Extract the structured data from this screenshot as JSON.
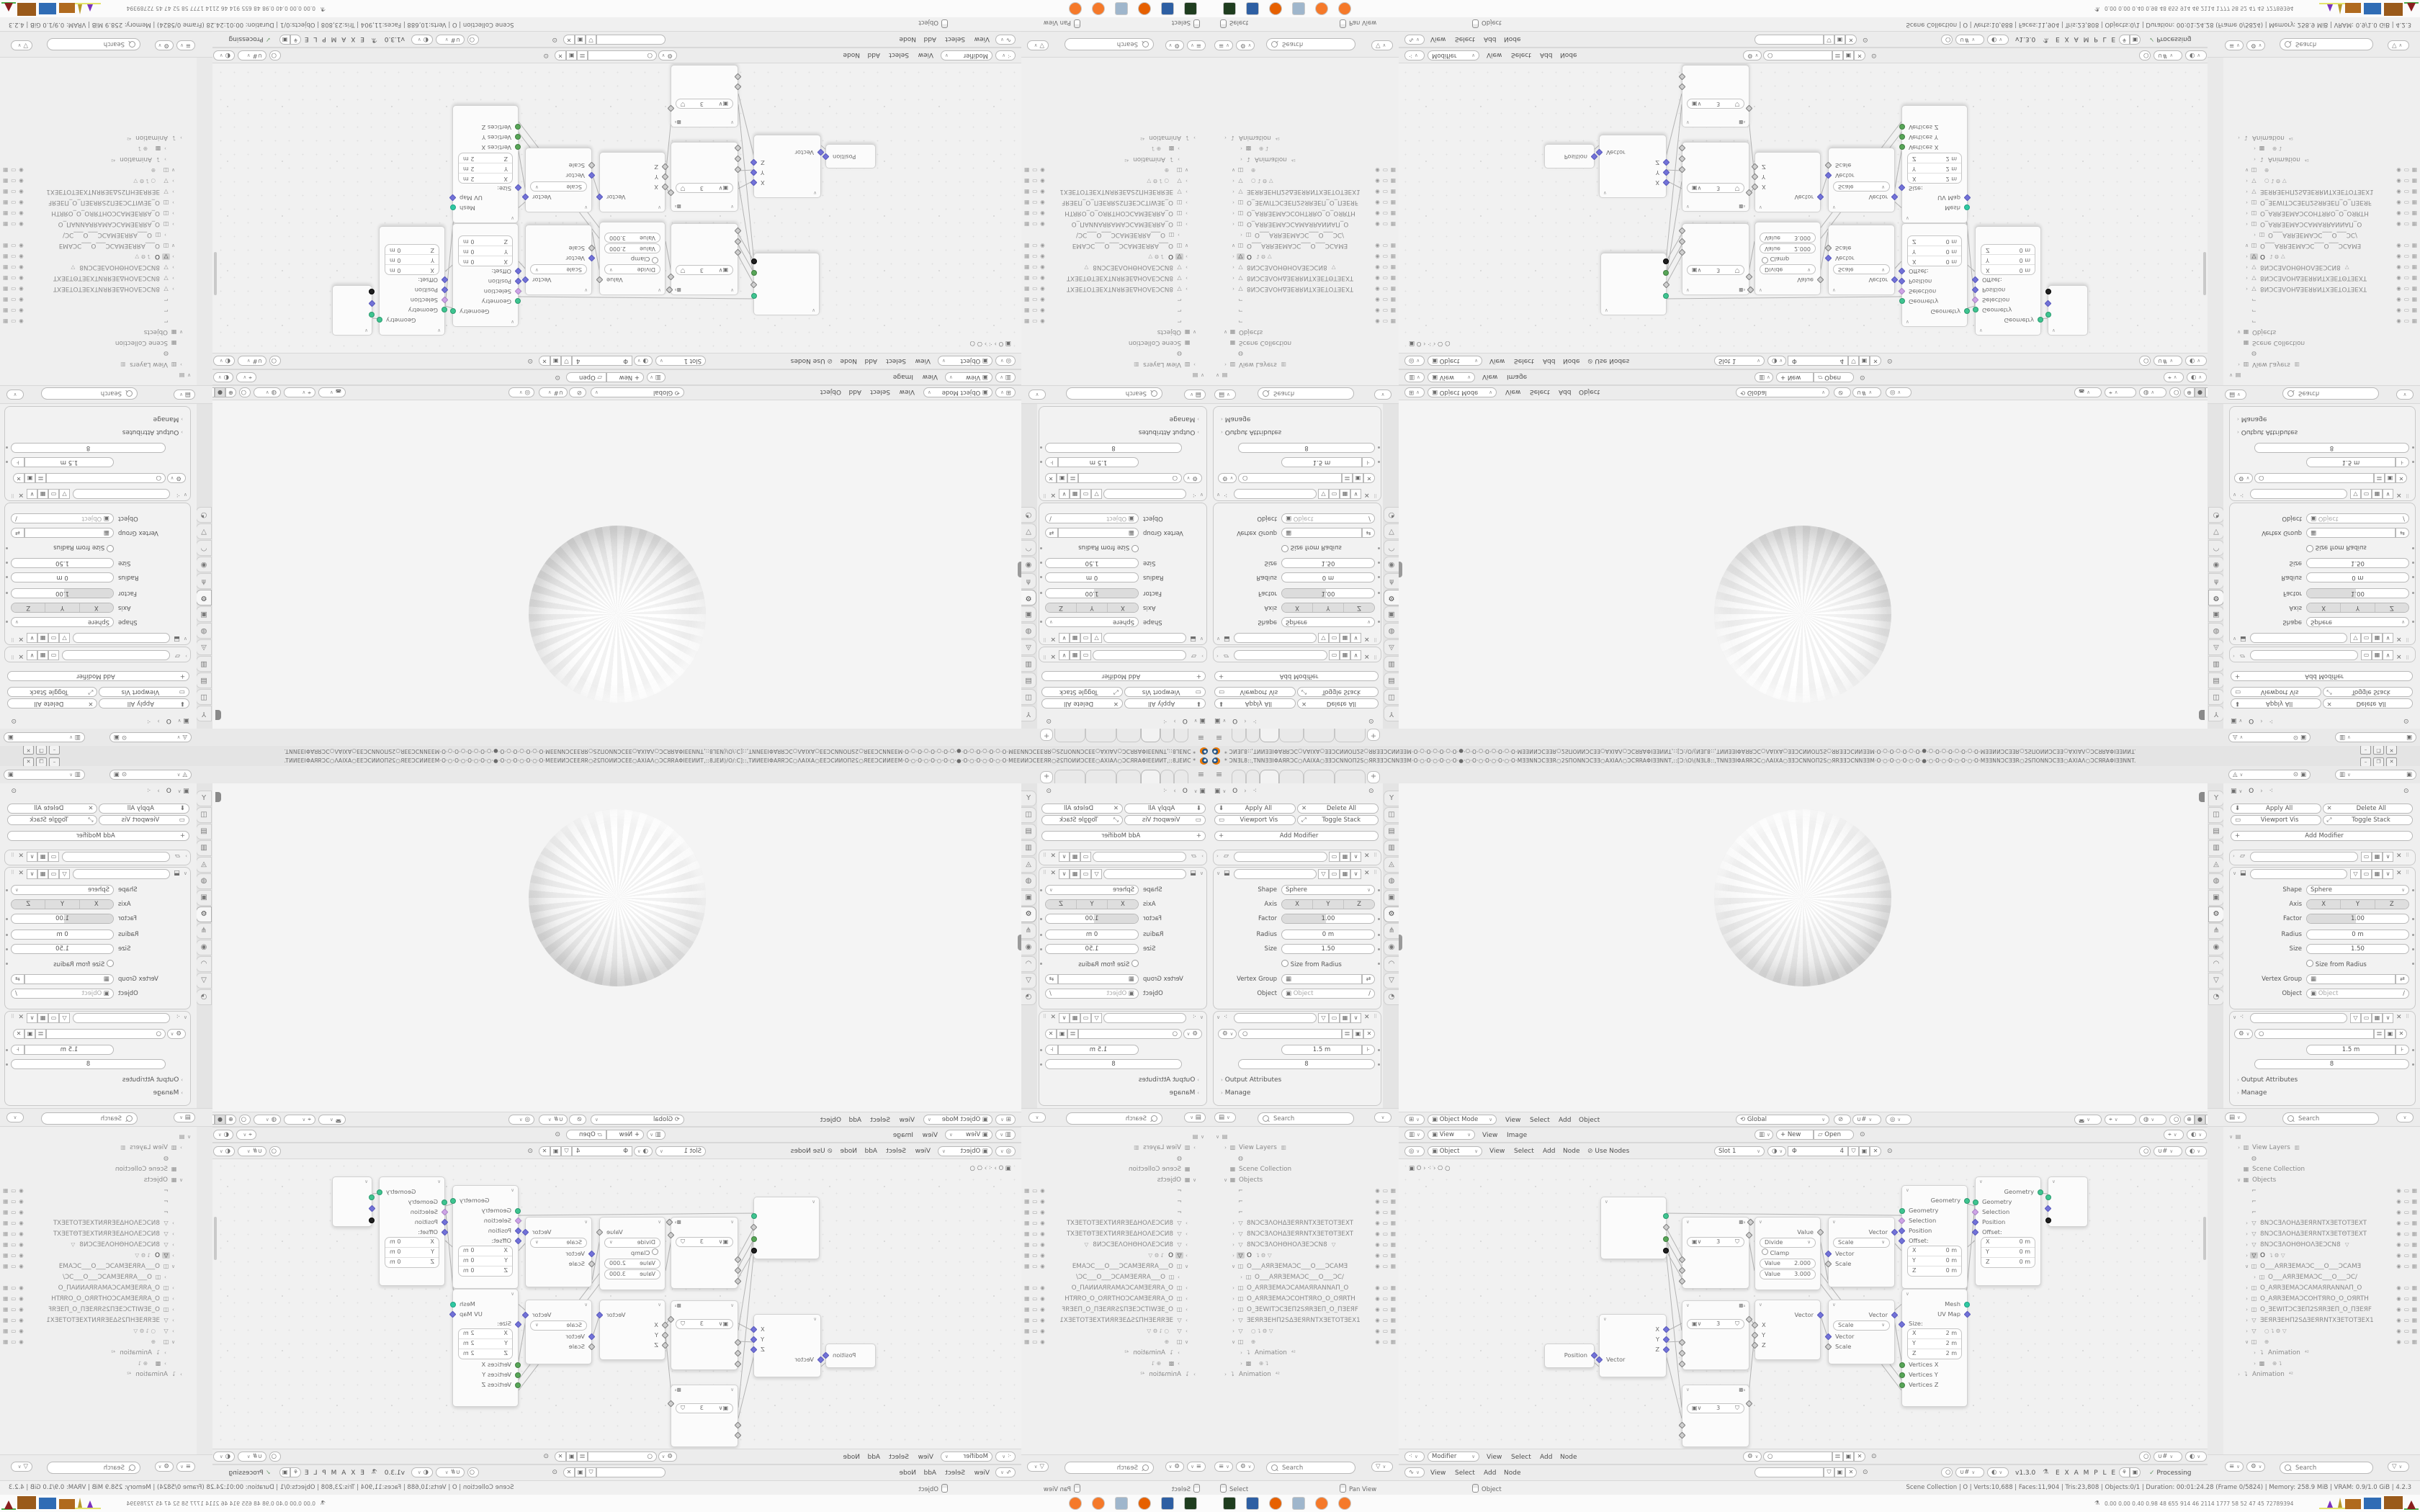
{
  "titlebar": {
    "title": "* ƆNƎL8::,TNNƎƎIΦAЯRƆC○ΛAIXA○ƎƎƆCNNOΠ2S○ЯRƎƎƆCNNƎƎM·O·○·O·○·O·○·O·●·○·O·○·O·○·O·○·O·MƎƎNNƆCƎƎR○2SΠONNƆCƎƎ○AXIAΛ○ƆCЯRAΦIƎƎNNT,::[Ɔ:\\O\\(NƎL8::,TNNƎƎIΦAЯRƆC○ΛAIXA○ƎƎƆCNNOΠ2S○ЯRƎƎƆCNNƎƎM·O·○·O·○·O·○·O·●·○·O·○·O·○·O·○·O·MƎƎNNƆCƎƎR○2SΠONNƆCƎƎ○AXIAΛ○ƆCЯRAΦIƎƎNNT.",
    "minimize": "–",
    "maximize": "❐",
    "close": "✕"
  },
  "topbar": {
    "add_tab": "+"
  },
  "scene_selector": {
    "value": "",
    "viewlayer": ""
  },
  "properties": {
    "breadcrumb_object": "O",
    "toolbar": {
      "apply_all": "Apply All",
      "delete_all": "Delete All",
      "viewport_vis": "Viewport Vis",
      "toggle_stack": "Toggle Stack",
      "add_modifier": "Add Modifier"
    },
    "cast": {
      "shape_label": "Shape",
      "shape_value": "Sphere",
      "axis_label": "Axis",
      "axis_x": "X",
      "axis_y": "Y",
      "axis_z": "Z",
      "factor_label": "Factor",
      "factor_value": "1.00",
      "radius_label": "Radius",
      "radius_value": "0 m",
      "size_label": "Size",
      "size_value": "1.50",
      "size_from_radius": "Size from Radius",
      "vertex_group_label": "Vertex Group",
      "object_label": "Object",
      "object_placeholder": "Object"
    },
    "geonodes": {
      "socket1_value": "1.5 m",
      "socket2_value": "8",
      "output_attributes": "Output Attributes",
      "manage": "Manage"
    },
    "nav_icons": [
      {
        "g": "Y",
        "name": "tool-tab"
      },
      {
        "g": "◫",
        "name": "render-tab"
      },
      {
        "g": "▤",
        "name": "output-tab"
      },
      {
        "g": "▥",
        "name": "view-layer-tab"
      },
      {
        "g": "◬",
        "name": "scene-tab"
      },
      {
        "g": "◍",
        "name": "world-tab"
      },
      {
        "g": "▣",
        "name": "object-tab"
      },
      {
        "g": "⚙",
        "name": "modifiers-tab",
        "active": 1
      },
      {
        "g": "⋔",
        "name": "constraints-tab"
      },
      {
        "g": "◉",
        "name": "particles-tab"
      },
      {
        "g": "◠",
        "name": "physics-tab"
      },
      {
        "g": "▽",
        "name": "data-tab"
      },
      {
        "g": "◔",
        "name": "material-tab"
      }
    ]
  },
  "outliner": {
    "search_placeholder": "Search",
    "rows": [
      {
        "ind": 0,
        "disc": "∨",
        "icon": "▤",
        "label": "",
        "tog": 0
      },
      {
        "ind": 1,
        "disc": "›",
        "icon": "▥",
        "label": "View Layers",
        "extra": "▥",
        "tog": 0
      },
      {
        "ind": 2,
        "disc": "",
        "icon": "◍",
        "label": "",
        "tog": 0
      },
      {
        "ind": 1,
        "disc": "",
        "icon": "▦",
        "label": "Scene Collection",
        "tog": 0
      },
      {
        "ind": 1,
        "disc": "∨",
        "icon": "▦",
        "label": "Objects",
        "tog": 0
      },
      {
        "ind": 2,
        "disc": "",
        "icon": "⌐",
        "label": "",
        "tog": 1
      },
      {
        "ind": 2,
        "disc": "",
        "icon": "⌐",
        "label": "",
        "tog": 1
      },
      {
        "ind": 2,
        "disc": "",
        "icon": "⌐",
        "label": "",
        "tog": 1
      },
      {
        "ind": 2,
        "disc": "›",
        "icon": "▽",
        "label": "8NƆCƎΛOHΔƎEЯRNTXƎETOTƎEXT",
        "tog": 1
      },
      {
        "ind": 2,
        "disc": "›",
        "icon": "▽",
        "label": "8NƆCƎΛOHΔƎEЯRNTXƎETΘTƎEXT",
        "tog": 1
      },
      {
        "ind": 2,
        "disc": "›",
        "icon": "▽",
        "label": "8NƆCƎΛOHΘHOΛƎEƆCN8",
        "extra": "▽",
        "tog": 1
      },
      {
        "ind": 2,
        "disc": "›",
        "icon": "▽",
        "label": "O",
        "extra": "⮧ ⚙ ▽",
        "tog": 1,
        "act": 1
      },
      {
        "ind": 2,
        "disc": "∨",
        "icon": "◫",
        "label": "O___AЯRƎEMAƆC___O___ƆCAMƎ",
        "tog": 1
      },
      {
        "ind": 3,
        "disc": "›",
        "icon": "◫",
        "label": "O___AЯRƎEMAƆC___O___ƆC/",
        "tog": 0
      },
      {
        "ind": 2,
        "disc": "›",
        "icon": "◫",
        "label": "O_AЯRƎEMAƆCAMAЯRANNAΠ_O",
        "tog": 1
      },
      {
        "ind": 2,
        "disc": "›",
        "icon": "◫",
        "label": "O_AЯRƎEMAƆCOHTЯRO_O_OЯRTH",
        "tog": 1
      },
      {
        "ind": 2,
        "disc": "›",
        "icon": "◫",
        "label": "O_ƎEWITƆCƎEΠ2SЯRƎEΠ_O_ΠƎEЯF",
        "tog": 1
      },
      {
        "ind": 2,
        "disc": "›",
        "icon": "▽",
        "label": "ƎEЯRƎEHΠ2SΔƎEЯRNTXƎETOTƎEX1",
        "tog": 1
      },
      {
        "ind": 2,
        "disc": "›",
        "icon": "▽",
        "label": "",
        "extra": "○   ⮧ ⚙ ▽",
        "tog": 1
      },
      {
        "ind": 2,
        "disc": "∨",
        "icon": "◫",
        "label": "",
        "extra": "⊕",
        "tog": 1
      },
      {
        "ind": 3,
        "disc": "›",
        "icon": "⮧",
        "label": "Animation",
        "extra": "⁴²",
        "tog": 0
      },
      {
        "ind": 3,
        "disc": "›",
        "icon": "▩",
        "label": "",
        "extra": "⊕  ⮧",
        "tog": 0
      },
      {
        "ind": 1,
        "disc": "›",
        "icon": "⮧",
        "label": "Animation",
        "extra": "⁴²",
        "tog": 0
      }
    ]
  },
  "viewport": {
    "mode": "Object Mode",
    "menu_view": "View",
    "menu_select": "Select",
    "menu_add": "Add",
    "menu_object": "Object",
    "orientation": "Global"
  },
  "image_editor": {
    "view_mode": "View",
    "menu_view": "View",
    "menu_image": "Image",
    "new_button": "New",
    "open_button": "Open"
  },
  "shader_editor": {
    "type": "Object",
    "menu_view": "View",
    "menu_select": "Select",
    "menu_add": "Add",
    "menu_node": "Node",
    "use_nodes": "Use Nodes",
    "slot": "Slot 1",
    "material_name": "Φ",
    "users": "4"
  },
  "geo_editor": {
    "context": "Modifier",
    "menu_view": "View",
    "menu_select": "Select",
    "menu_add": "Add",
    "menu_node": "Node",
    "breadcrumb_object": "O"
  },
  "node2_editor": {
    "menu_view": "View",
    "menu_select": "Select",
    "menu_add": "Add",
    "menu_node": "Node",
    "version": "v1.3.0",
    "label": "E X A M P L E S",
    "status": "Processing",
    "check": "✓"
  },
  "nodes": {
    "position": {
      "out": "Position"
    },
    "separate_xyz": {
      "out_x": "X",
      "out_y": "Y",
      "out_z": "Z",
      "in_vector": "Vector"
    },
    "group": {
      "count": "3"
    },
    "math": {
      "out": "Value",
      "operation": "Divide",
      "clamp": "Clamp",
      "val_label": "Value",
      "value1": "2.000",
      "value2": "3.000"
    },
    "combine_xyz": {
      "out": "Vector",
      "in_x": "X",
      "in_y": "Y",
      "in_z": "Z"
    },
    "vector_math": {
      "out": "Vector",
      "operation": "Scale",
      "in_vector": "Vector",
      "in_scale": "Scale"
    },
    "set_position": {
      "out": "Geometry",
      "in_geometry": "Geometry",
      "in_selection": "Selection",
      "in_position": "Position",
      "in_offset": "Offset:",
      "x": "X",
      "y": "Y",
      "z": "Z",
      "zero": "0 m"
    },
    "cube": {
      "out_mesh": "Mesh",
      "out_uv": "UV Map",
      "size": "Size:",
      "x": "X",
      "y": "Y",
      "z": "Z",
      "two": "2 m",
      "in_vx": "Vertices X",
      "in_vy": "Vertices Y",
      "in_vz": "Vertices Z"
    }
  },
  "status_bar": {
    "hint_left": "Select",
    "hint_middle": "Pan View",
    "hint_right": "Object",
    "stats": "Scene Collection | O | Verts:10,688 | Faces:11,904 | Tris:23,808 | Objects:0/1 | Duration: 00:01:24.28 (Frame 0/5824) | Memory: 258.9 MiB | VRAM: 0.9/1.0 GiB | 4.2.3"
  },
  "taskbar": {
    "apps": [
      {
        "name": "terminal-icon",
        "cls": "a-term"
      },
      {
        "name": "floppy-64-icon",
        "cls": "a-floppy"
      },
      {
        "name": "firefox-icon",
        "cls": "a-ff"
      },
      {
        "name": "calculator-icon",
        "cls": "a-calc"
      },
      {
        "name": "blender-icon",
        "cls": "a-blend"
      },
      {
        "name": "blender-icon-2",
        "cls": "a-blend"
      }
    ],
    "monitor_values": "0.00 0.00 0.40 0.98   48   655  914   46   2114 1777   58    52    47    45  72789394"
  }
}
